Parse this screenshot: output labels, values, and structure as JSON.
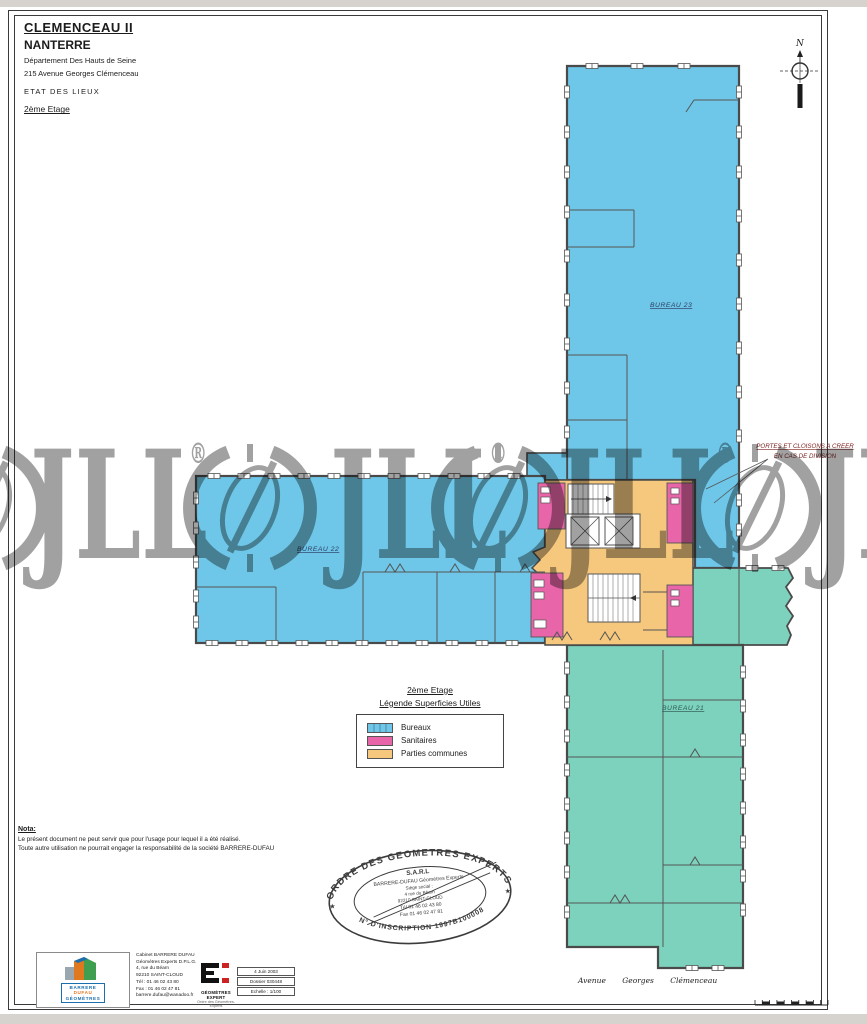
{
  "title_block": {
    "building": "CLEMENCEAU II",
    "city": "NANTERRE",
    "dept": "Département Des Hauts de Seine",
    "address": "215 Avenue Georges Clémenceau",
    "doc_type": "ETAT DES LIEUX",
    "floor": "2ème Etage"
  },
  "north_label": "N",
  "plan": {
    "bureau23": "BUREAU 23",
    "bureau22": "BUREAU 22",
    "bureau21": "BUREAU 21",
    "annotation_line1": "PORTES ET CLOISONS A CREER",
    "annotation_line2": "EN CAS DE DIVISION",
    "street": "Avenue Georges Clémenceau"
  },
  "legend": {
    "floor": "2ème Etage",
    "title": "Légende Superficies Utiles",
    "items": [
      {
        "label": "Bureaux",
        "color": "#6ec7e8"
      },
      {
        "label": "Sanitaires",
        "color": "#e765a8"
      },
      {
        "label": "Parties communes",
        "color": "#f6c87d"
      }
    ]
  },
  "nota": {
    "heading": "Nota:",
    "line1": "Le présent document ne peut servir que pour l'usage pour lequel il a été réalisé.",
    "line2": "Toute autre utilisation ne pourrait engager la responsabilité de la société BARRERE-DUFAU"
  },
  "stamp": {
    "arc_top": "ORDRE DES GEOMETRES EXPERTS",
    "arc_bottom": "N° D'INSCRIPTION 1997B100008",
    "line1": "S.A.R.L",
    "line2": "BARRERE-DUFAU Géomètres Experts",
    "line3": "Siège social :",
    "line4": "4 rue du Béarn",
    "line5": "92210 SAINT-CLOUD",
    "line6": "Tél 01 46 02 43 80",
    "line7": "Fax 01 46 02 47 81",
    "star": "★"
  },
  "footer": {
    "bd_line1": "BARRERE",
    "bd_line2": "DUFAU",
    "bd_line3": "GÉOMÈTRES",
    "company_lines": [
      "Cabinet BARRERE DUFAU",
      "Géomètres Experts D.P.L.G.",
      "4, rue du Béarn",
      "92210 SAINT-CLOUD",
      "Tél : 01 46 02 43 80",
      "Fax : 01 46 02 47 81",
      "barrere.dufau@wanadoo.fr"
    ],
    "ge_name": "GÉOMÈTRES EXPERT",
    "ge_sub": "Ordre des Géomètres-Experts",
    "table": [
      "4 Juin 2003",
      "Dossier 030448",
      "Echelle : 1/100"
    ]
  },
  "watermark": {
    "text": "JLL",
    "reg": "®"
  }
}
